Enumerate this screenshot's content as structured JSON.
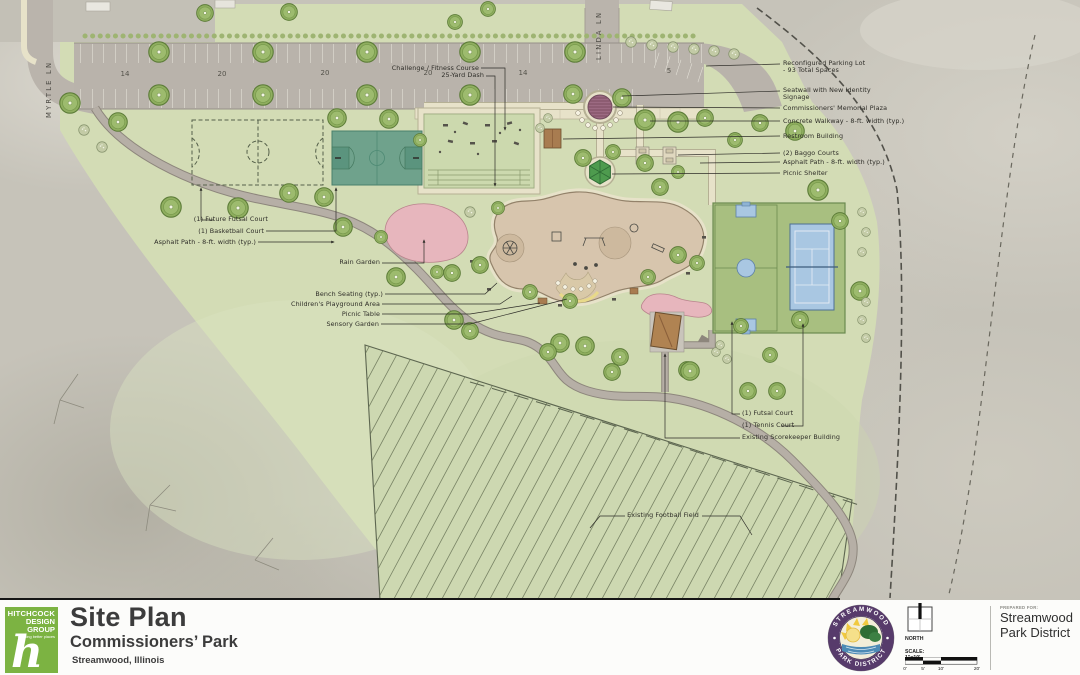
{
  "plan_labels": [
    {
      "text": "Reconfigured Parking Lot\n- 93 Total Spaces",
      "x": 783,
      "y": 60
    },
    {
      "text": "Seatwall with New Identity\nSignage",
      "x": 783,
      "y": 87
    },
    {
      "text": "Commissioners' Memorial Plaza",
      "x": 783,
      "y": 105
    },
    {
      "text": "Concrete Walkway - 8-ft. width (typ.)",
      "x": 783,
      "y": 118
    },
    {
      "text": "Restroom Building",
      "x": 783,
      "y": 133
    },
    {
      "text": "(2) Baggo Courts",
      "x": 783,
      "y": 150
    },
    {
      "text": "Asphalt Path - 8-ft. width (typ.)",
      "x": 783,
      "y": 159
    },
    {
      "text": "Picnic Shelter",
      "x": 783,
      "y": 170
    },
    {
      "text": "(1) Future Futsal Court",
      "x": 268,
      "y": 216,
      "align": "right"
    },
    {
      "text": "(1) Basketball Court",
      "x": 264,
      "y": 228,
      "align": "right"
    },
    {
      "text": "Asphalt Path - 8-ft. width (typ.)",
      "x": 256,
      "y": 239,
      "align": "right"
    },
    {
      "text": "Rain Garden",
      "x": 380,
      "y": 259,
      "align": "right"
    },
    {
      "text": "Bench Seating (typ.)",
      "x": 383,
      "y": 291,
      "align": "right"
    },
    {
      "text": "Children's Playground Area",
      "x": 380,
      "y": 301,
      "align": "right"
    },
    {
      "text": "Picnic Table",
      "x": 380,
      "y": 311,
      "align": "right"
    },
    {
      "text": "Sensory Garden",
      "x": 379,
      "y": 321,
      "align": "right"
    },
    {
      "text": "Challenge / Fitness Course",
      "x": 479,
      "y": 65,
      "align": "right"
    },
    {
      "text": "25-Yard Dash",
      "x": 484,
      "y": 72,
      "align": "right"
    },
    {
      "text": "(1) Futsal Court",
      "x": 742,
      "y": 410
    },
    {
      "text": "(1) Tennis Court",
      "x": 742,
      "y": 422
    },
    {
      "text": "Existing Scorekeeper Building",
      "x": 742,
      "y": 434
    },
    {
      "text": "Existing Football Field",
      "x": 663,
      "y": 512,
      "align": "center"
    },
    {
      "text": "14",
      "x": 125,
      "y": 71,
      "align": "center",
      "cls": "num"
    },
    {
      "text": "20",
      "x": 222,
      "y": 71,
      "align": "center",
      "cls": "num"
    },
    {
      "text": "20",
      "x": 325,
      "y": 70,
      "align": "center",
      "cls": "num"
    },
    {
      "text": "20",
      "x": 428,
      "y": 70,
      "align": "center",
      "cls": "num"
    },
    {
      "text": "14",
      "x": 523,
      "y": 70,
      "align": "center",
      "cls": "num"
    },
    {
      "text": "5",
      "x": 669,
      "y": 68,
      "align": "center",
      "cls": "num"
    },
    {
      "text": "MYRTLE LN",
      "x": 46,
      "y": 118,
      "cls": "street"
    },
    {
      "text": "LINDA LN",
      "x": 596,
      "y": 60,
      "cls": "street"
    }
  ],
  "title_block": {
    "logo_line1": "HITCHCOCK",
    "logo_line2": "DESIGN",
    "logo_line3": "GROUP",
    "logo_tagline": "creating better places",
    "logo_glyph": "h",
    "title": "Site Plan",
    "subtitle": "Commissioners’ Park",
    "location": "Streamwood, Illinois",
    "north_label": "NORTH",
    "scale_label": "SCALE: 1\"=10'",
    "scale_ticks": [
      "0'",
      "5'",
      "10'",
      "20'"
    ],
    "seal_top": "STREAMWOOD",
    "seal_bottom": "PARK DISTRICT",
    "prepared_for_label": "PREPARED FOR:",
    "prepared_for_line1": "Streamwood",
    "prepared_for_line2": "Park District"
  },
  "colors": {
    "park_green": "#d3dcb5",
    "field_green": "#cdd8b1",
    "asphalt": "#b6afa6",
    "road_gray": "#bab4ac",
    "walk_beige": "#e7e2c9",
    "court_teal": "#6fa28c",
    "court_green": "#a8bf80",
    "tennis_blue": "#a9c7e2",
    "playground_tan": "#d7c5ad",
    "garden_pink": "#e7b6bd",
    "plaza_purple": "#9c6a82",
    "tree_green": "#8fae5f",
    "logo_green": "#7cb342",
    "seal_purple": "#573b6b"
  }
}
